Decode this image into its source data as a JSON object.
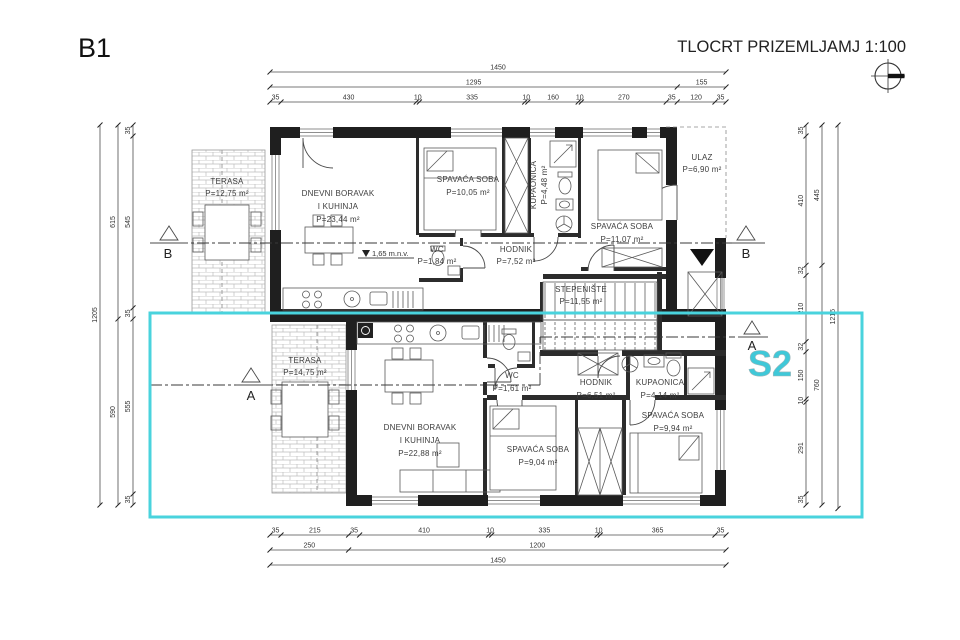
{
  "title": "B1",
  "header": {
    "title": "TLOCRT PRIZEMLJA",
    "scale": "MJ 1:100"
  },
  "s2_label": "S2",
  "elevation_note": "1,65 m.n.v.",
  "sections": {
    "a": "A",
    "b": "B"
  },
  "colors": {
    "highlight_box": "#49d3dd",
    "s2_text": "#3fc8d8",
    "wall": "#1f1f1f"
  },
  "icons": {
    "compass": "north-compass-icon",
    "entry_arrow": "entry-arrow-icon"
  },
  "rooms": {
    "terasa_upper": {
      "name": "TERASA",
      "area": "P=12,75 m²"
    },
    "living_upper": {
      "line1": "DNEVNI BORAVAK",
      "line2": "I KUHINJA",
      "area": "P=23,44 m²"
    },
    "bedroom1_upper": {
      "name": "SPAVAĆA SOBA",
      "area": "P=10,05 m²"
    },
    "bath_upper": {
      "name": "KUPAONICA",
      "area": "P=4,48 m²"
    },
    "ulaz": {
      "name": "ULAZ",
      "area": "P=6,90 m²"
    },
    "bedroom2_upper": {
      "name": "SPAVAĆA SOBA",
      "area": "P=11,07 m²"
    },
    "wc_upper": {
      "name": "WC",
      "area": "P=1,84 m²"
    },
    "hodnik_upper": {
      "name": "HODNIK",
      "area": "P=7,52 m²"
    },
    "stepeniste": {
      "name": "STEPENIŠTE",
      "area": "P=11,55 m²"
    },
    "terasa_lower": {
      "name": "TERASA",
      "area": "P=14,75 m²"
    },
    "living_lower": {
      "line1": "DNEVNI BORAVAK",
      "line2": "I KUHINJA",
      "area": "P=22,88 m²"
    },
    "wc_lower": {
      "name": "WC",
      "area": "P=1,61 m²"
    },
    "hodnik_lower": {
      "name": "HODNIK",
      "area": "P=6,51 m²"
    },
    "bath_lower": {
      "name": "KUPAONICA",
      "area": "P=4,14 m²"
    },
    "bedroom1_lower": {
      "name": "SPAVAĆA SOBA",
      "area": "P=9,04 m²"
    },
    "bedroom2_lower": {
      "name": "SPAVAĆA SOBA",
      "area": "P=9,94 m²"
    }
  },
  "dimensions": {
    "top": [
      [
        1450
      ],
      [
        1295,
        155
      ],
      [
        35,
        430,
        10,
        335,
        10,
        160,
        10,
        270,
        35,
        120,
        35
      ]
    ],
    "bottom": [
      [
        35,
        215,
        35,
        410,
        10,
        335,
        10,
        365,
        35
      ],
      [
        250,
        1200
      ],
      [
        1450
      ]
    ],
    "left": [
      [
        1205
      ],
      [
        615,
        590
      ],
      [
        35,
        545,
        35,
        555,
        35
      ]
    ],
    "right": [
      [
        35,
        410,
        32,
        210,
        32,
        150,
        10,
        291,
        35
      ],
      [
        445,
        760
      ],
      [
        1216
      ]
    ]
  }
}
